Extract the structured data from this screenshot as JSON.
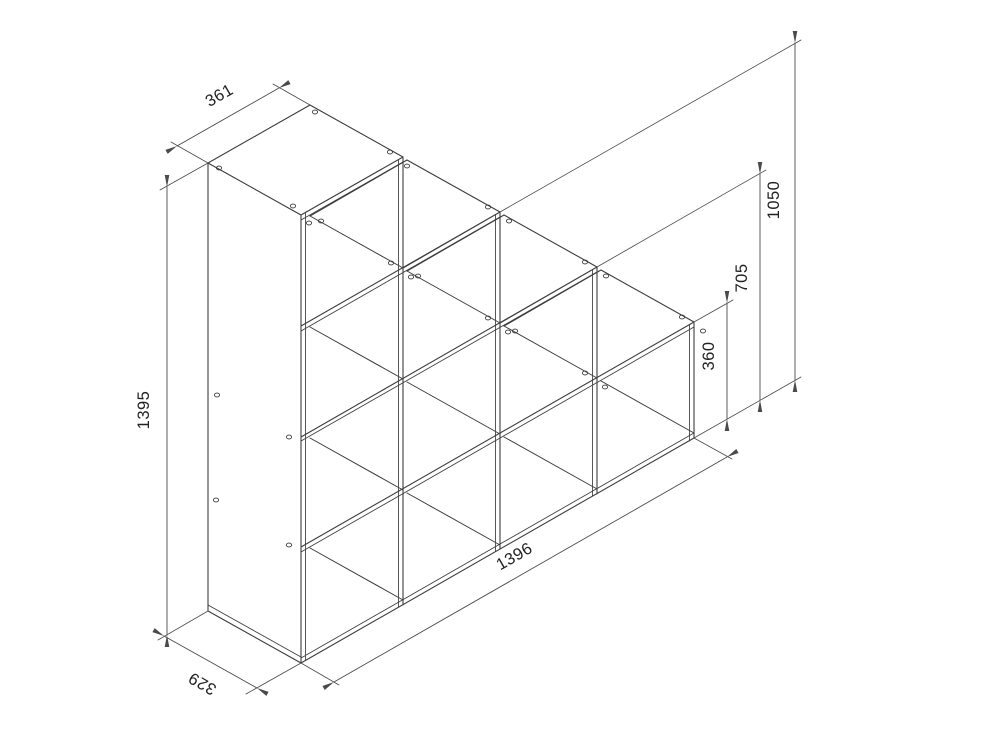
{
  "drawing": {
    "kind": "isometric furniture dimension drawing",
    "subject": "staircase cube shelf unit, open cubes, no back panel",
    "background": "#ffffff",
    "line_color": "#3c3c3c",
    "text_color": "#222222",
    "structure": {
      "columns": 4,
      "rows_per_column": [
        4,
        3,
        2,
        1
      ],
      "open_cubes": 10
    },
    "dimensions": [
      {
        "name": "top-left-width",
        "value": "361"
      },
      {
        "name": "left-overall-height",
        "value": "1395"
      },
      {
        "name": "bottom-left-depth",
        "value": "329"
      },
      {
        "name": "bottom-overall-width",
        "value": "1396"
      },
      {
        "name": "right-step-height-1",
        "value": "1050"
      },
      {
        "name": "right-step-height-2",
        "value": "705"
      },
      {
        "name": "right-step-height-3",
        "value": "360"
      }
    ]
  }
}
